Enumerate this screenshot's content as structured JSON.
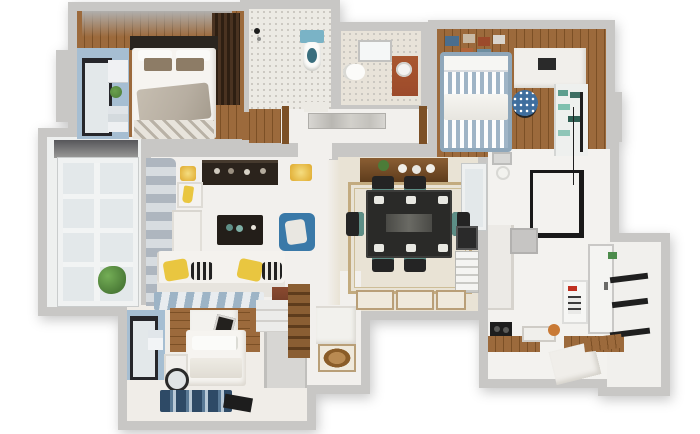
{
  "scene": {
    "type": "3d-floorplan-render",
    "description": "Top-down 3D rendered floor plan of a three-bedroom apartment on a white background",
    "background": "#ffffff"
  },
  "palette": {
    "bg": "#ffffff",
    "wall": "#c8c7c5",
    "wall_hi": "#d8d7d5",
    "wall_dark": "#aeadab",
    "floor_white": "#f2f0ed",
    "floor_cream": "#e9e3d5",
    "tile_border": "#c3ab7f",
    "mosaic": "#eceae4",
    "mosaic_dot": "#c9c6bf",
    "wood": "#9c6a3c",
    "wood_dark": "#7c5026",
    "dark_wood": "#3a2a18",
    "dark": "#2a251f",
    "bed_white": "#f6f4f0",
    "blanket": "#b7aea1",
    "pillow_brown": "#8d7c66",
    "blue_wall": "#a6bed2",
    "blue": "#3a79a8",
    "stripe_blue": "#9fb4c6",
    "teal": "#5d8e86",
    "yellow": "#e9c640",
    "curtain_dark": "#aeb6bf",
    "curtain_light": "#d7dce0",
    "rug_blue": "#2e4a66",
    "black": "#1b1b1b",
    "glass": "#e3e8ea",
    "plant": "#4c7c38",
    "terra": "#9c4a2b",
    "orange": "#c97a35"
  },
  "rooms": [
    {
      "name": "master-bedroom",
      "items": [
        "double-bed",
        "dark-headboard",
        "white-pillows",
        "brown-pillows",
        "gray-blanket",
        "patterned-throw",
        "dark-wardrobe",
        "blue-window-niche",
        "black-window",
        "wall-shelf",
        "plant"
      ]
    },
    {
      "name": "bathroom-main",
      "items": [
        "mosaic-floor",
        "toilet-teal-tank",
        "shower-head"
      ]
    },
    {
      "name": "bathroom-second",
      "items": [
        "skylight",
        "toilet",
        "terracotta-vanity"
      ]
    },
    {
      "name": "hallway",
      "items": [
        "wall-art",
        "wood-door-frames",
        "wood-floor-patch"
      ]
    },
    {
      "name": "kids-bedroom",
      "items": [
        "wall-picture-frames",
        "striped-bed",
        "white-blanket",
        "desk",
        "laptop",
        "polka-dot-chair",
        "bookshelf",
        "teal-books"
      ]
    },
    {
      "name": "balcony-left",
      "items": [
        "grid-window",
        "dark-beam",
        "potted-plant"
      ]
    },
    {
      "name": "living-room",
      "items": [
        "gray-curtains",
        "tv-console",
        "sconce-left",
        "sconce-right",
        "shelf-upper",
        "yellow-vase",
        "shelf-lower",
        "coffee-table",
        "blue-armchair",
        "sofa",
        "yellow-pillow-1",
        "striped-pillow-1",
        "yellow-pillow-2",
        "striped-pillow-2",
        "striped-rug",
        "brown-side-cabinet"
      ]
    },
    {
      "name": "dining-room",
      "items": [
        "tile-border",
        "sideboard",
        "plates",
        "plant",
        "window",
        "dining-table",
        "table-plates",
        "chair-top-1",
        "chair-top-2",
        "chair-bottom-1",
        "chair-bottom-2",
        "chair-left",
        "chair-right",
        "black-grid",
        "radiator",
        "deco-tile-1",
        "deco-tile-2",
        "deco-tile-3"
      ]
    },
    {
      "name": "kitchen",
      "items": [
        "ceiling-vent",
        "pendant-light",
        "pot-rack-window",
        "tall-cabinet",
        "gray-appliance",
        "stove",
        "sink",
        "orange-pot",
        "wood-counter-left",
        "wood-counter-right",
        "white-island",
        "water-heater"
      ]
    },
    {
      "name": "balcony-right",
      "items": [
        "white-door",
        "black-shelf-1",
        "black-shelf-2",
        "black-shelf-3",
        "wood-shelf"
      ]
    },
    {
      "name": "bedroom-second",
      "items": [
        "blue-window-niche",
        "black-window",
        "wood-accent-wall",
        "white-panel",
        "picture-frame",
        "bed",
        "pillows",
        "blanket",
        "nightstand",
        "round-mirror",
        "blue-rug",
        "dark-bench",
        "wardrobe",
        "wood-desk",
        "white-appliance",
        "steps"
      ]
    },
    {
      "name": "entry-foyer",
      "items": [
        "shoe-cabinet",
        "white-bench",
        "floor-medallion"
      ]
    }
  ]
}
